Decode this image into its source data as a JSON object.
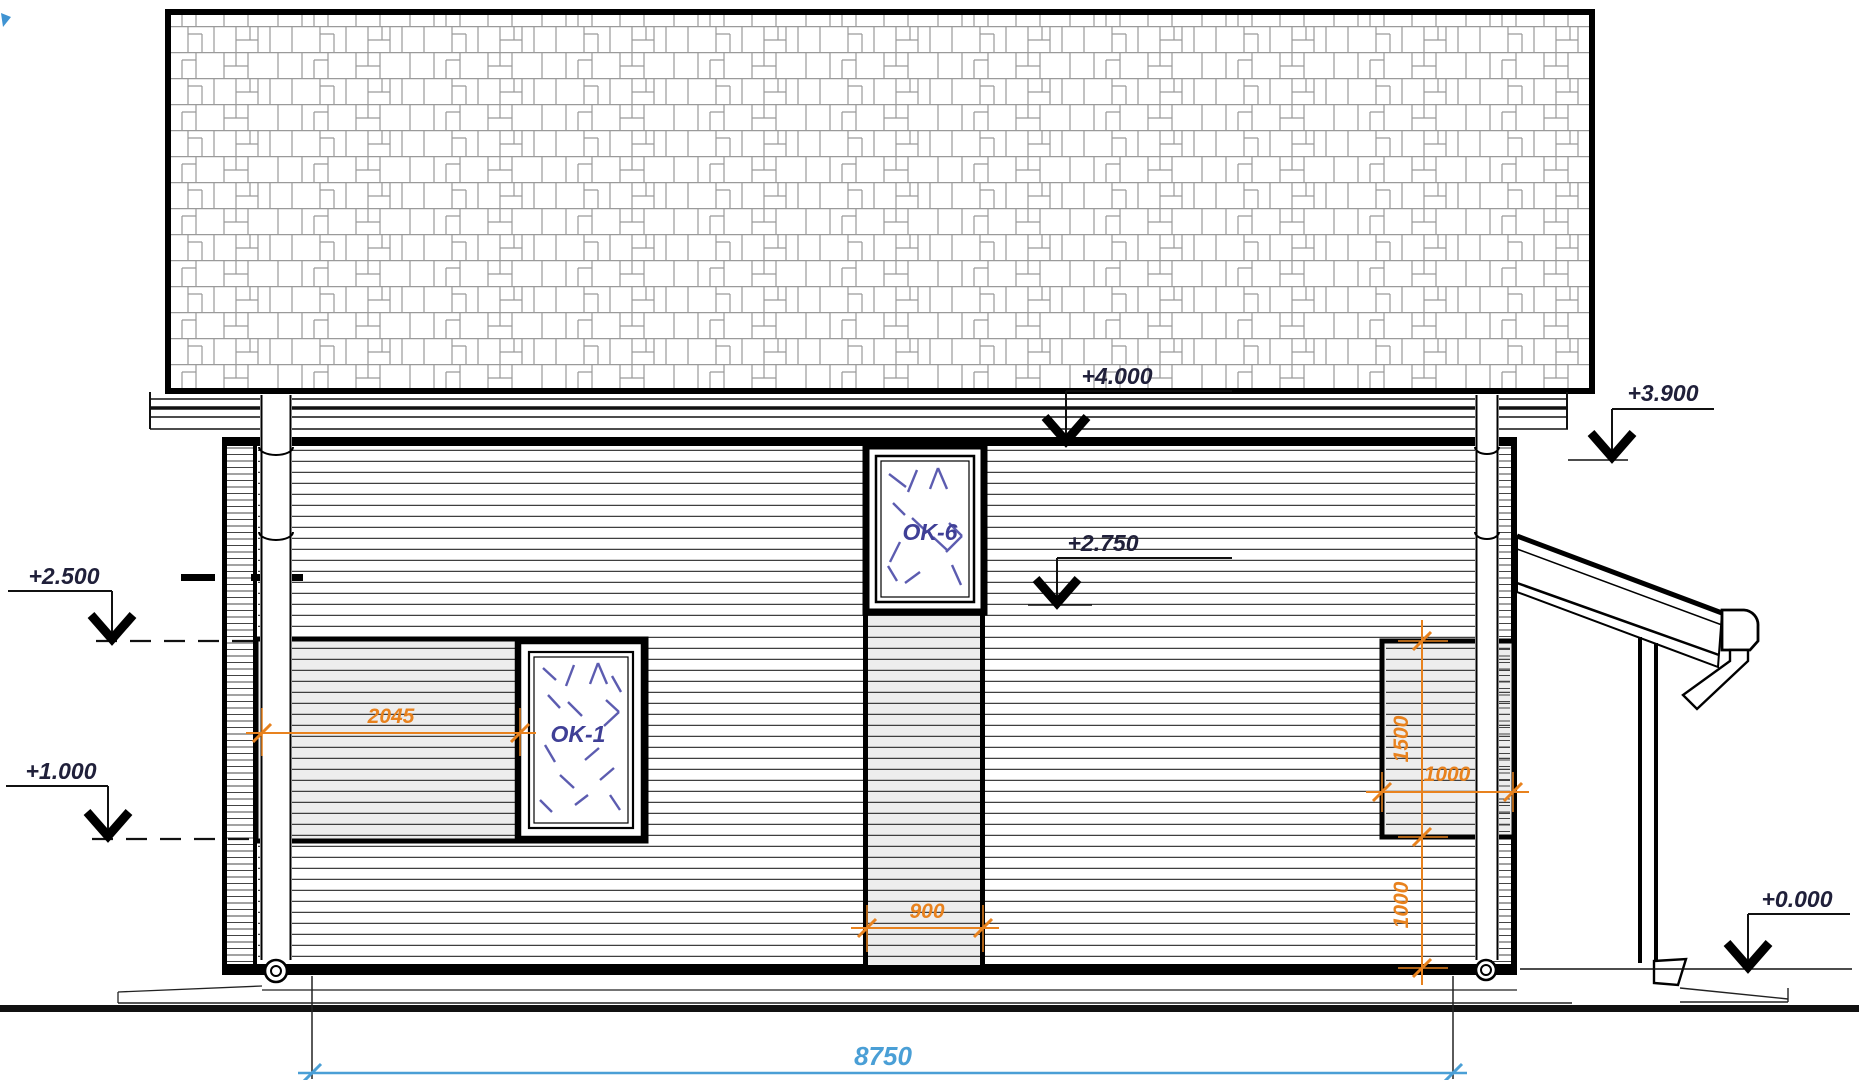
{
  "drawing_type": "house-side-elevation",
  "elevation_markers": {
    "eave_ridge": "+4.000",
    "right_eave": "+3.900",
    "upper_level": "+2.750",
    "window_head": "+2.500",
    "window_sill": "+1.000",
    "ground_floor": "+0.000"
  },
  "dimensions": {
    "left_window_offset": "2045",
    "center_strip_width": "900",
    "right_opening_height": "1500",
    "right_opening_width": "1000",
    "right_opening_sill": "1000",
    "overall_width": "8750"
  },
  "windows": {
    "upper": "OK-6",
    "lower": "OK-1"
  },
  "colors": {
    "dimension": "#e8821e",
    "overall_dimension": "#4a9fd6",
    "window_label": "#3f3f96",
    "levels": "#20203a",
    "glass_marks": "#5c5cb0"
  }
}
